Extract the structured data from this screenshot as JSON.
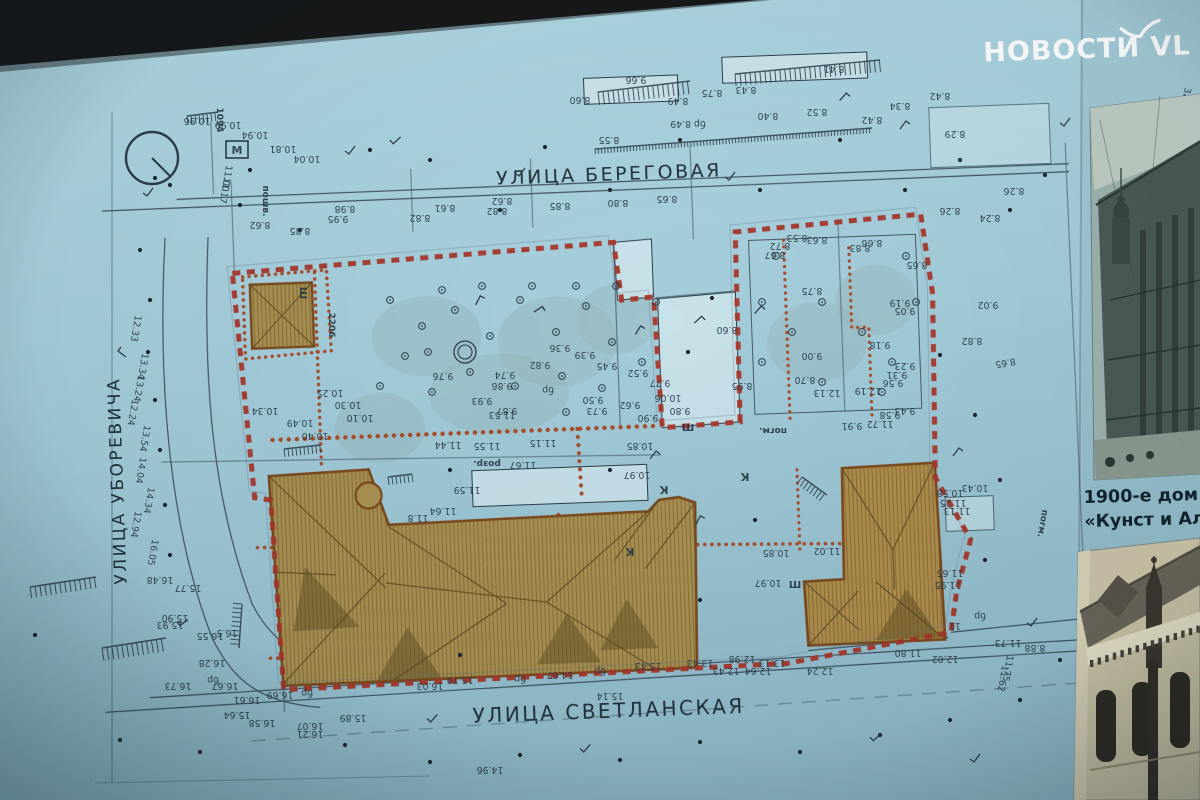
{
  "watermark": {
    "text": "НОВОСТИ VL"
  },
  "photo_panel": {
    "caption_line1": "1900-е дом",
    "caption_line2": "«Кунст и Ал"
  },
  "plan": {
    "streets": {
      "top": "УЛИЦА БЕРЕГОВАЯ",
      "bottom": "УЛИЦА СВЕТЛАНСКАЯ",
      "left": "УЛИЦА УБОРЕВИЧА"
    },
    "colors": {
      "paper_teal": "#a7cfdc",
      "boundary_red": "#a6372b",
      "dotted_red": "#a84e2a",
      "building_tan": "#ab9152",
      "line_dark": "#2e3e4a"
    },
    "elevation_labels": [
      [
        "8.60",
        580,
        97
      ],
      [
        "9.66",
        636,
        77
      ],
      [
        "8.49",
        678,
        98
      ],
      [
        "8.43",
        746,
        87
      ],
      [
        "8.41",
        834,
        66
      ],
      [
        "8.55",
        609,
        137
      ],
      [
        "бр 8.49",
        688,
        121
      ],
      [
        "8.40",
        768,
        113
      ],
      [
        "8.52",
        817,
        109
      ],
      [
        "8.42",
        872,
        117
      ],
      [
        "8.75",
        712,
        90
      ],
      [
        "8.34",
        900,
        103
      ],
      [
        "8.42",
        940,
        93
      ],
      [
        "8.26",
        1014,
        188
      ],
      [
        "8.29",
        955,
        131
      ],
      [
        "32",
        1184,
        93,
        100
      ],
      [
        "8.62",
        502,
        198
      ],
      [
        "8.82",
        497,
        208
      ],
      [
        "8.65",
        667,
        196
      ],
      [
        "8.85",
        560,
        203
      ],
      [
        "8.80",
        618,
        200
      ],
      [
        "8.61",
        445,
        205
      ],
      [
        "8.98",
        345,
        206
      ],
      [
        "9.95",
        338,
        216
      ],
      [
        "8.82",
        420,
        215
      ],
      [
        "8.26",
        950,
        208
      ],
      [
        "8.24",
        990,
        215
      ],
      [
        "8.62",
        260,
        222
      ],
      [
        "8.85",
        300,
        228
      ],
      [
        "8.53",
        797,
        235
      ],
      [
        "8.63",
        817,
        237
      ],
      [
        "8.83",
        860,
        245
      ],
      [
        "8.66",
        872,
        240
      ],
      [
        "8.72",
        780,
        243
      ],
      [
        "8.67",
        775,
        252
      ],
      [
        "8.75",
        812,
        288
      ],
      [
        "8.65",
        917,
        262
      ],
      [
        "9.19",
        900,
        300
      ],
      [
        "9.05",
        905,
        308
      ],
      [
        "8.60",
        727,
        327
      ],
      [
        "9.00",
        812,
        353
      ],
      [
        "8.70",
        805,
        377
      ],
      [
        "9.18",
        880,
        342
      ],
      [
        "9.23",
        905,
        363
      ],
      [
        "9.31",
        897,
        372
      ],
      [
        "9.56",
        893,
        380
      ],
      [
        "12.13",
        827,
        390
      ],
      [
        "12.19",
        868,
        388
      ],
      [
        "8.95",
        742,
        383
      ],
      [
        "9.58",
        890,
        412
      ],
      [
        "11.72",
        880,
        421
      ],
      [
        "9.91",
        852,
        423
      ],
      [
        "9.43",
        905,
        408
      ],
      [
        "8.82",
        972,
        338
      ],
      [
        "9.02",
        988,
        302
      ],
      [
        "8.65",
        1005,
        360,
        170
      ],
      [
        "9.36",
        560,
        345
      ],
      [
        "9.39",
        585,
        352
      ],
      [
        "9.76",
        443,
        373
      ],
      [
        "9.74",
        505,
        372
      ],
      [
        "9.86",
        502,
        383
      ],
      [
        "9.82",
        540,
        362
      ],
      [
        "9.93",
        482,
        398
      ],
      [
        "9.87",
        507,
        408
      ],
      [
        "9.73",
        597,
        408
      ],
      [
        "9.50",
        593,
        397
      ],
      [
        "9.62",
        630,
        402
      ],
      [
        "9.90",
        648,
        415
      ],
      [
        "9.77",
        660,
        380
      ],
      [
        "10.06",
        668,
        395
      ],
      [
        "9.80",
        680,
        408
      ],
      [
        "10.25",
        330,
        390
      ],
      [
        "10.30",
        348,
        402
      ],
      [
        "10.10",
        360,
        415
      ],
      [
        "10.49",
        300,
        420
      ],
      [
        "10.40",
        315,
        433
      ],
      [
        "9.45",
        607,
        363
      ],
      [
        "9.52",
        638,
        370
      ],
      [
        "бр",
        548,
        387
      ],
      [
        "10.34",
        265,
        408
      ],
      [
        "11.44",
        448,
        442
      ],
      [
        "11.55",
        487,
        443
      ],
      [
        "11.15",
        543,
        440
      ],
      [
        "11.53",
        502,
        412
      ],
      [
        "11.67",
        523,
        462
      ],
      [
        "10.85",
        640,
        443
      ],
      [
        "10.97",
        637,
        472
      ],
      [
        "11.59",
        467,
        487
      ],
      [
        "11.64",
        443,
        508
      ],
      [
        "11.8",
        418,
        515
      ],
      [
        "10.85",
        776,
        550
      ],
      [
        "10.97",
        768,
        580
      ],
      [
        "11.02",
        827,
        548
      ],
      [
        "12.33",
        133,
        328,
        100
      ],
      [
        "13.34",
        140,
        366,
        100
      ],
      [
        "13.24",
        136,
        388,
        100
      ],
      [
        "12.24",
        130,
        412,
        100
      ],
      [
        "13.54",
        142,
        438,
        100
      ],
      [
        "14.04",
        138,
        470,
        100
      ],
      [
        "14.34",
        146,
        500,
        100
      ],
      [
        "12.94",
        133,
        524,
        100
      ],
      [
        "16.05",
        150,
        552,
        100
      ],
      [
        "10.96",
        197,
        118
      ],
      [
        "10.99",
        228,
        122
      ],
      [
        "11.00",
        224,
        178,
        100
      ],
      [
        "11.17",
        222,
        190,
        100
      ],
      [
        "10.81",
        283,
        146
      ],
      [
        "10.04",
        307,
        156
      ],
      [
        "10.94",
        255,
        132
      ],
      [
        "15.77",
        188,
        585
      ],
      [
        "15.90",
        175,
        615
      ],
      [
        "15.93",
        170,
        622
      ],
      [
        "16.55",
        210,
        633
      ],
      [
        "16.5",
        227,
        630
      ],
      [
        "16.28",
        212,
        660
      ],
      [
        "16.73",
        178,
        683
      ],
      [
        "16.67",
        225,
        683
      ],
      [
        "16.61",
        247,
        697
      ],
      [
        "16.69",
        280,
        692
      ],
      [
        "16.58",
        262,
        720
      ],
      [
        "16.07",
        310,
        723
      ],
      [
        "16.21",
        310,
        731
      ],
      [
        "15.89",
        353,
        715
      ],
      [
        "бр",
        213,
        677
      ],
      [
        "бр",
        307,
        690
      ],
      [
        "16.48",
        160,
        577
      ],
      [
        "15.64",
        237,
        712
      ],
      [
        "14.67",
        560,
        672
      ],
      [
        "15.79",
        460,
        677
      ],
      [
        "16.03",
        430,
        683
      ],
      [
        "15.43",
        648,
        663
      ],
      [
        "15.14",
        610,
        693
      ],
      [
        "13.43",
        700,
        660
      ],
      [
        "12.98",
        742,
        656
      ],
      [
        "12.64",
        758,
        668
      ],
      [
        "12.02",
        945,
        656
      ],
      [
        "11.80",
        908,
        650
      ],
      [
        "12.24",
        820,
        668
      ],
      [
        "14.96",
        490,
        767
      ],
      [
        "12.43",
        726,
        668
      ],
      [
        "13.13",
        772,
        660
      ],
      [
        "бр",
        600,
        668
      ],
      [
        "бр",
        520,
        676
      ],
      [
        "10.58",
        950,
        490
      ],
      [
        "10.43",
        975,
        485
      ],
      [
        "11.25",
        953,
        500
      ],
      [
        "11.13",
        957,
        508
      ],
      [
        "11.65",
        950,
        570
      ],
      [
        "11.95",
        948,
        582
      ],
      [
        "11.75",
        1005,
        668,
        100
      ],
      [
        "11.62",
        1000,
        678,
        100
      ],
      [
        "бр",
        980,
        613
      ],
      [
        "11",
        955,
        623
      ],
      [
        "8.88",
        1035,
        645
      ],
      [
        "11.73",
        1008,
        640
      ]
    ],
    "annotations": [
      [
        "М",
        237,
        151,
        0,
        11,
        1
      ],
      [
        "Ш",
        300,
        290,
        90,
        10
      ],
      [
        "Ш",
        688,
        428,
        0,
        10
      ],
      [
        "Ш",
        795,
        585,
        0,
        10
      ],
      [
        "К",
        630,
        545,
        180,
        11
      ],
      [
        "К",
        745,
        470,
        180,
        11
      ],
      [
        "К",
        664,
        483,
        180,
        11
      ],
      [
        "розр.",
        487,
        458,
        180,
        9
      ],
      [
        "пошв.",
        263,
        198,
        90,
        9
      ],
      [
        "погм.",
        773,
        425,
        180,
        9
      ],
      [
        "погм.",
        1040,
        520,
        100,
        9
      ],
      [
        "2206",
        329,
        322,
        90,
        9
      ],
      [
        "1094",
        217,
        117,
        90,
        9
      ]
    ]
  }
}
